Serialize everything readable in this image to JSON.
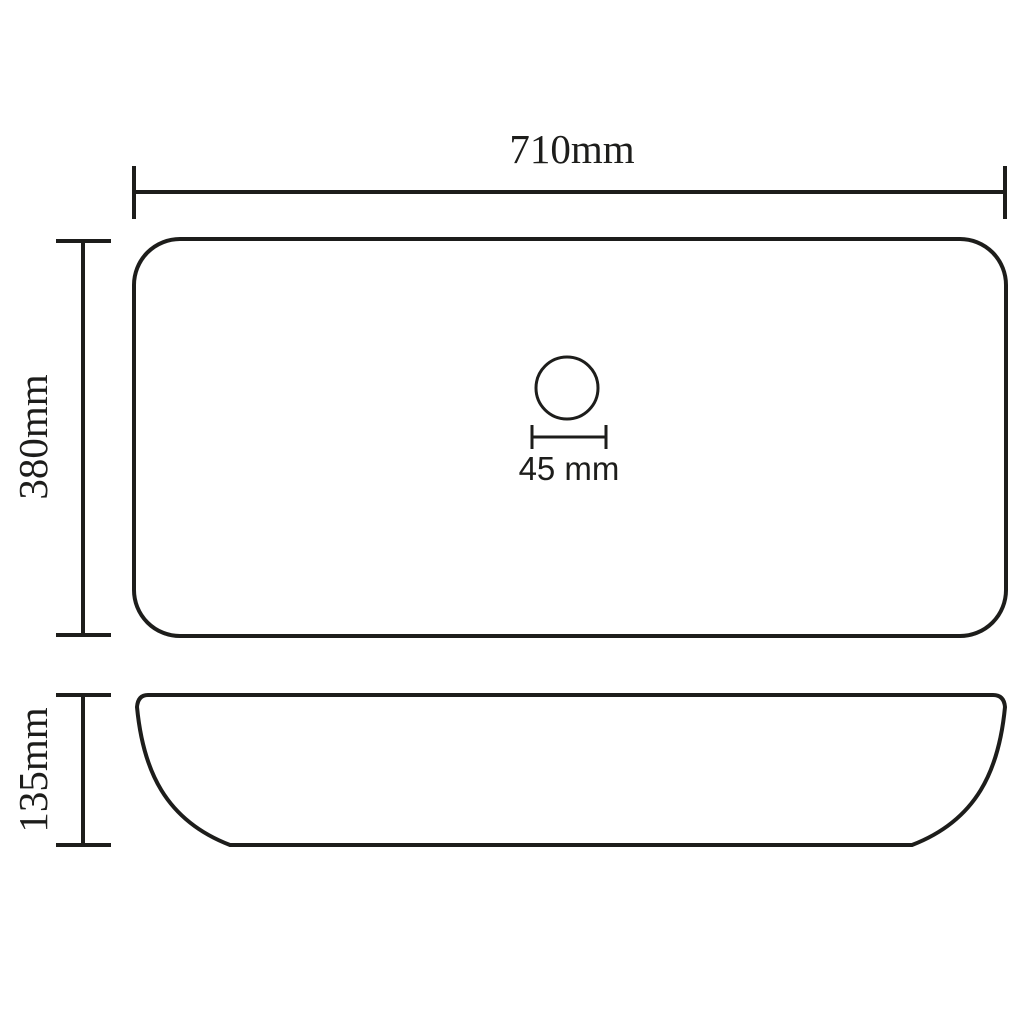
{
  "drawing": {
    "title": "Sink technical dimension drawing",
    "subject": "rectangular countertop wash basin",
    "views": [
      {
        "name": "top-view",
        "description": "plan view rounded rectangle with drain hole"
      },
      {
        "name": "side-view",
        "description": "side profile with curved hull-like underside"
      }
    ]
  },
  "colors": {
    "line": "#1d1d1b",
    "background": "#ffffff"
  },
  "dimensions": {
    "width": {
      "label": "710mm",
      "value_mm": 710,
      "applies_to": "top-view overall width"
    },
    "depth": {
      "label": "380mm",
      "value_mm": 380,
      "applies_to": "top-view overall depth"
    },
    "height": {
      "label": "135mm",
      "value_mm": 135,
      "applies_to": "side-view overall height"
    },
    "drain": {
      "label": "45 mm",
      "value_mm": 45,
      "applies_to": "drain hole diameter"
    }
  }
}
